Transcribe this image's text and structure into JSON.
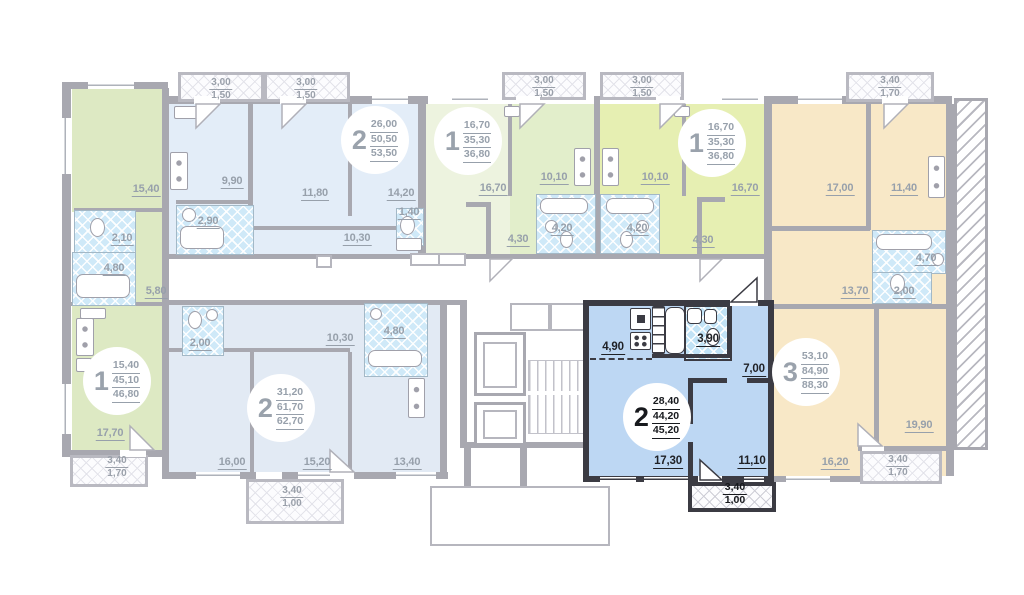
{
  "floorplan": {
    "kind": "apartment-floor-plan",
    "colors": {
      "selected_fill": "#bdd7f3",
      "selected_wall": "#3b3b43",
      "wall": "#a8a8b0",
      "bathroom_fill": "#cfe9f8",
      "green_apartment": "#dde9c3",
      "blue_apartment": "#e3edf8",
      "lime_apartment": "#e6efb2",
      "beige_apartment": "#f8e8c7"
    },
    "selected_apartment": {
      "rooms": "2",
      "living_area": "28,40",
      "total_area": "44,20",
      "total_area_with_balcony": "45,20"
    },
    "apartments": [
      {
        "id": "left-corner-1-room",
        "digit": "1",
        "selected": false,
        "badge": {
          "x": 117,
          "y": 381,
          "values": [
            "15,40",
            "45,10",
            "46,80"
          ]
        },
        "labels": [
          {
            "v": "15,40",
            "x": 146,
            "y": 189
          },
          {
            "v": "2,10",
            "x": 122,
            "y": 238
          },
          {
            "v": "4,80",
            "x": 114,
            "y": 268
          },
          {
            "v": "5,80",
            "x": 156,
            "y": 291
          },
          {
            "v": "17,70",
            "x": 110,
            "y": 433
          }
        ]
      },
      {
        "id": "top-2-room",
        "digit": "2",
        "selected": false,
        "badge": {
          "x": 375,
          "y": 140,
          "values": [
            "26,00",
            "50,50",
            "53,50"
          ]
        },
        "labels": [
          {
            "v": "9,90",
            "x": 232,
            "y": 181
          },
          {
            "v": "11,80",
            "x": 315,
            "y": 193
          },
          {
            "v": "14,20",
            "x": 401,
            "y": 193
          },
          {
            "v": "2,90",
            "x": 208,
            "y": 221
          },
          {
            "v": "1,40",
            "x": 409,
            "y": 212
          },
          {
            "v": "10,30",
            "x": 357,
            "y": 238
          }
        ]
      },
      {
        "id": "middle-left-1-room",
        "digit": "1",
        "selected": false,
        "badge": {
          "x": 468,
          "y": 141,
          "values": [
            "16,70",
            "35,30",
            "36,80"
          ]
        },
        "labels": [
          {
            "v": "16,70",
            "x": 493,
            "y": 188
          },
          {
            "v": "10,10",
            "x": 554,
            "y": 177
          },
          {
            "v": "4,20",
            "x": 562,
            "y": 228
          },
          {
            "v": "4,30",
            "x": 518,
            "y": 239
          }
        ]
      },
      {
        "id": "middle-right-1-room",
        "digit": "1",
        "selected": false,
        "badge": {
          "x": 712,
          "y": 143,
          "values": [
            "16,70",
            "35,30",
            "36,80"
          ]
        },
        "labels": [
          {
            "v": "10,10",
            "x": 655,
            "y": 177
          },
          {
            "v": "4,20",
            "x": 637,
            "y": 228
          },
          {
            "v": "4,30",
            "x": 703,
            "y": 240
          },
          {
            "v": "16,70",
            "x": 745,
            "y": 188
          }
        ]
      },
      {
        "id": "right-corner-3-room",
        "digit": "3",
        "selected": false,
        "badge": {
          "x": 806,
          "y": 372,
          "values": [
            "53,10",
            "84,90",
            "88,30"
          ]
        },
        "labels": [
          {
            "v": "17,00",
            "x": 840,
            "y": 188
          },
          {
            "v": "11,40",
            "x": 904,
            "y": 188
          },
          {
            "v": "4,70",
            "x": 926,
            "y": 258
          },
          {
            "v": "13,70",
            "x": 855,
            "y": 291
          },
          {
            "v": "2,00",
            "x": 904,
            "y": 291
          },
          {
            "v": "19,90",
            "x": 919,
            "y": 425
          },
          {
            "v": "16,20",
            "x": 835,
            "y": 462
          }
        ]
      },
      {
        "id": "bottom-2-room",
        "digit": "2",
        "selected": false,
        "badge": {
          "x": 281,
          "y": 408,
          "values": [
            "31,20",
            "61,70",
            "62,70"
          ]
        },
        "labels": [
          {
            "v": "2,00",
            "x": 200,
            "y": 343
          },
          {
            "v": "10,30",
            "x": 340,
            "y": 338
          },
          {
            "v": "4,80",
            "x": 394,
            "y": 331
          },
          {
            "v": "16,00",
            "x": 232,
            "y": 462
          },
          {
            "v": "15,20",
            "x": 317,
            "y": 462
          },
          {
            "v": "13,40",
            "x": 407,
            "y": 462
          }
        ]
      },
      {
        "id": "selected-2-room",
        "digit": "2",
        "selected": true,
        "badge": {
          "x": 657,
          "y": 417,
          "values": [
            "28,40",
            "44,20",
            "45,20"
          ]
        },
        "labels": [
          {
            "v": "4,90",
            "x": 613,
            "y": 347
          },
          {
            "v": "3,90",
            "x": 708,
            "y": 339
          },
          {
            "v": "7,00",
            "x": 754,
            "y": 369
          },
          {
            "v": "17,30",
            "x": 668,
            "y": 461
          },
          {
            "v": "11,10",
            "x": 752,
            "y": 461
          }
        ]
      }
    ],
    "balconies": [
      {
        "top": "3,00",
        "bottom": "1,50",
        "x": 221,
        "y": 89,
        "selected": false
      },
      {
        "top": "3,00",
        "bottom": "1,50",
        "x": 306,
        "y": 89,
        "selected": false
      },
      {
        "top": "3,00",
        "bottom": "1,50",
        "x": 544,
        "y": 87,
        "selected": false
      },
      {
        "top": "3,00",
        "bottom": "1,50",
        "x": 642,
        "y": 87,
        "selected": false
      },
      {
        "top": "3,40",
        "bottom": "1,70",
        "x": 890,
        "y": 87,
        "selected": false
      },
      {
        "top": "3,40",
        "bottom": "1,70",
        "x": 117,
        "y": 467,
        "selected": false
      },
      {
        "top": "3,40",
        "bottom": "1,00",
        "x": 292,
        "y": 497,
        "selected": false
      },
      {
        "top": "3,40",
        "bottom": "1,70",
        "x": 898,
        "y": 466,
        "selected": false
      },
      {
        "top": "3,40",
        "bottom": "1,00",
        "x": 735,
        "y": 494,
        "selected": true
      }
    ]
  }
}
